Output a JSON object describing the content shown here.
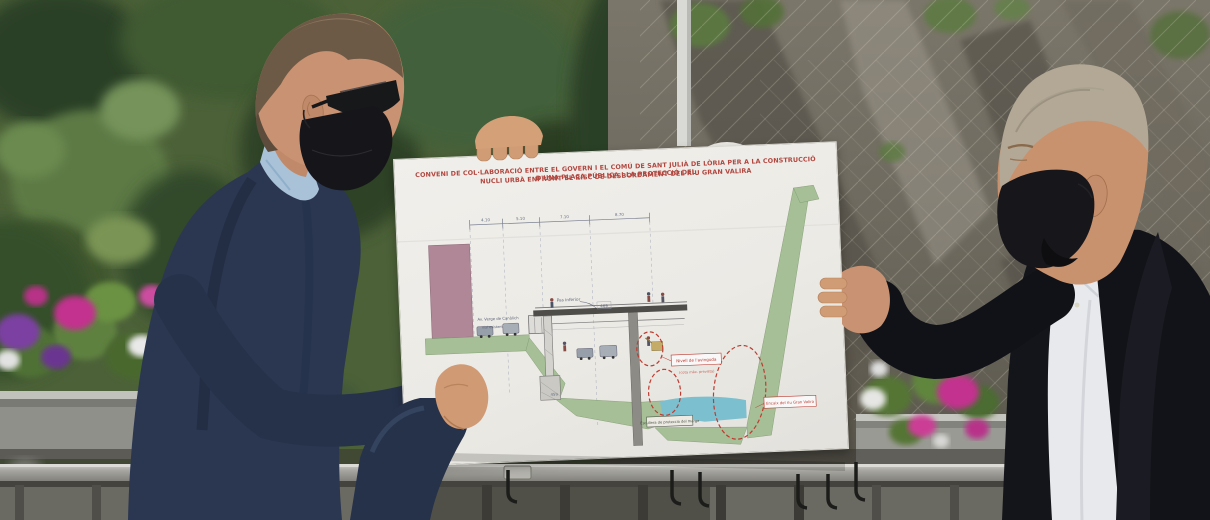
{
  "scene": {
    "type": "outdoor press photograph",
    "description": "Two officials wearing black face masks hold up a large white presentation board showing an engineering cross-section drawing; they stand behind flower planters and a grey metal railing, in front of a rocky cliff covered with protective netting and green foliage",
    "left_person": {
      "hair": "short brown",
      "eyewear": "sunglasses",
      "mask": "black",
      "jacket": "navy blue",
      "shirt": "light blue"
    },
    "right_person": {
      "hair": "balding grey-blond",
      "mask": "black",
      "jacket": "black",
      "shirt": "white open collar"
    },
    "flower_colors": [
      "magenta",
      "purple",
      "white"
    ],
    "railing": "grey metal handrail with vertical pickets and black planter hooks"
  },
  "poster": {
    "title": {
      "line1": "CONVENI DE COL·LABORACIÓ ENTRE EL GOVERN I EL COMÚ DE SANT JULIÀ DE LÒRIA PER A LA CONSTRUCCIÓ D'UNA PLAÇA PÚBLICA I LA PROTECCIÓ DEL",
      "line2": "NUCLI URBÀ ENFRONT EL RISC DE DESBORDAMENT DEL RIU GRAN VALIRA",
      "color": "#b5473f"
    },
    "diagram": {
      "type": "technical cross-section of riverside plaza and flood protection",
      "dims": [
        "4.10",
        "5.10",
        "7.10",
        "8.70"
      ],
      "elev_deck": "469",
      "elev_road": "459",
      "labels": {
        "road": "Av. Verge de Canòlich",
        "road_sub": "Vial existent",
        "underpass": "Pas inferior",
        "flood": "Nivell de l'avinguda",
        "flood_sub": "(cota màx. prevista)",
        "channel": "Encaix del riu Gran Valira",
        "bank": "Escullera de protecció del marge"
      },
      "colors": {
        "terrain": "#a9c49b",
        "building": "#b28a9a",
        "water": "#7dc5d6",
        "highlight": "#c23b30"
      }
    }
  }
}
